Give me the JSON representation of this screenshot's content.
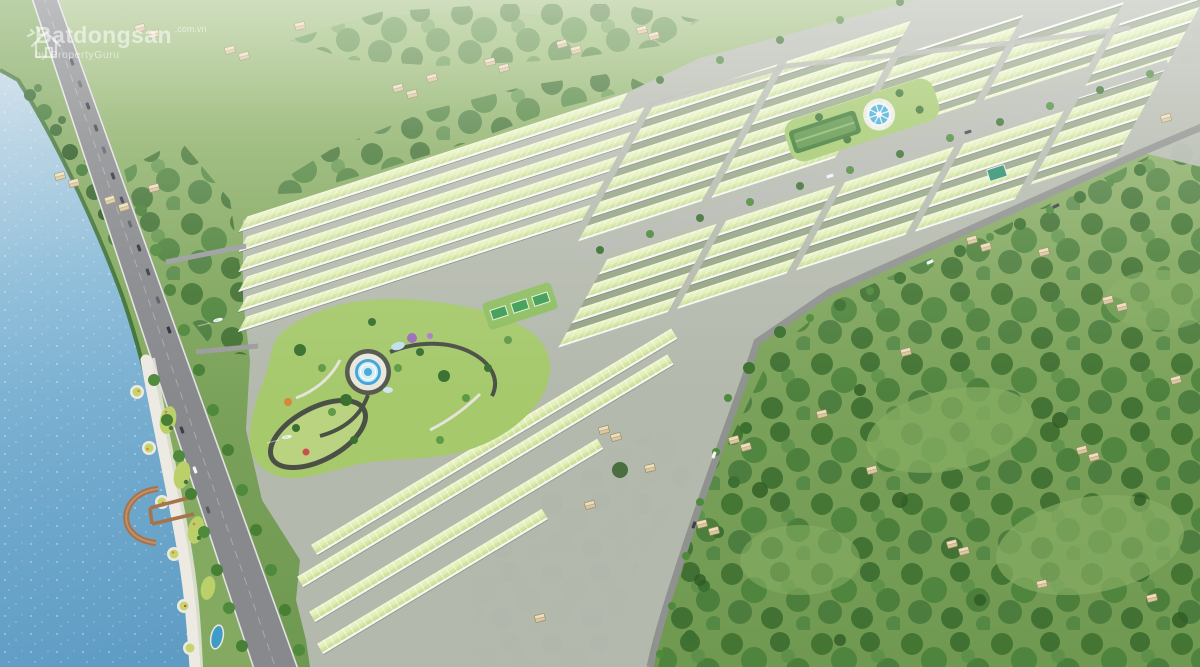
{
  "watermark": {
    "brand": "Batdongsan",
    "suffix": ".com.vn",
    "byline": "by PropertyGuru",
    "icon": "batdongsan-house-logo-icon"
  },
  "scene": {
    "description": "Aerial 3D masterplan render of a lakeside land-plot residential development: parallel rows of white shophouses with pale-green roofs, a central landscaped park with circular fountain plaza, a second fountain park at the top, sports courts, a waterfront boulevard with palm trees and parked cars, a scalloped lakeside promenade with a timber marina pier, tree-lined boundary roads, and surrounding green fields with scattered farm huts",
    "palette": {
      "lake_blue": "#7fb2d4",
      "field_green": "#7da45c",
      "forest_green": "#3c7030",
      "roof_green": "#dcecae",
      "facade_white": "#f7f8f1",
      "boulevard_gray": "#87898c",
      "street_gray": "#b7bab2",
      "promenade_white": "#eceae2",
      "fountain_blue": "#3fa8d8",
      "pier_brown": "#a6744c",
      "hut_tan": "#d9c8a0"
    },
    "features": [
      "lake",
      "marina-pier",
      "waterfront-boulevard",
      "promenade-gardens",
      "central-park",
      "fountain-plaza",
      "sports-courts",
      "rowhouse-blocks",
      "internal-streets",
      "boundary-road",
      "forest",
      "farm-huts",
      "watermark"
    ]
  }
}
